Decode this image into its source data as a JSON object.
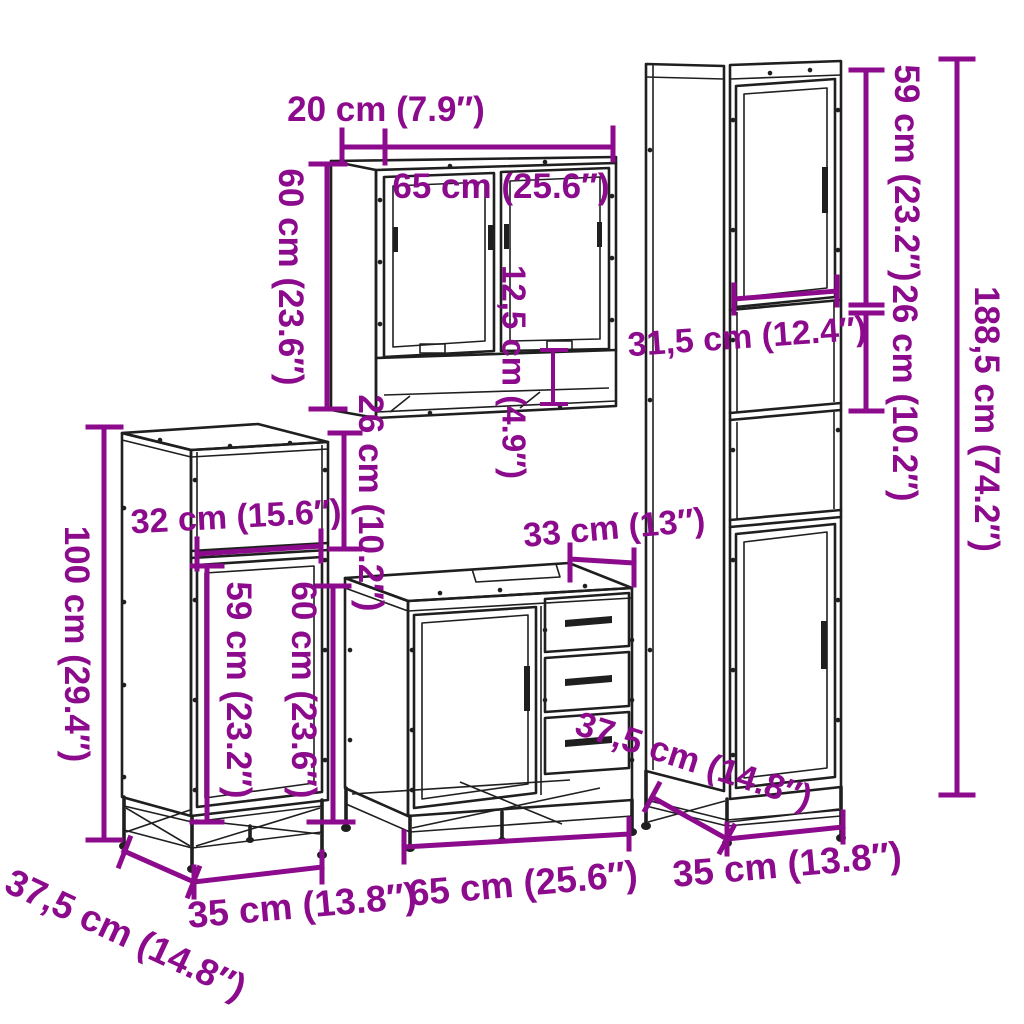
{
  "page": {
    "background": "#ffffff"
  },
  "colors": {
    "dimension_annotation": "#8c0a8c",
    "line_art": "#1f1f1f"
  },
  "diagram": {
    "title": "Bathroom furniture set dimension diagram",
    "pieces": {
      "mirror_cabinet": {
        "label": "wall mirror cabinet",
        "depth": "20 cm (7.9″)",
        "width": "65 cm (25.6″)",
        "height": "60 cm (23.6″)",
        "shelf_height": "12,5 cm (4.9″)",
        "wall_gap": "26 cm (10.2″)"
      },
      "tall_cabinet": {
        "label": "tall bathroom cabinet",
        "door_height": "59 cm (23.2″)",
        "shelf_height": "26 cm (10.2″)",
        "total_height": "188,5 cm (74.2″)",
        "inner_width": "31,5 cm (12.4″)",
        "width": "35 cm (13.8″)",
        "depth": "37,5 cm (14.8″)"
      },
      "side_cabinet": {
        "label": "low bathroom cabinet",
        "height": "100 cm (29.4″)",
        "inner_width": "32 cm (15.6″)",
        "door_height": "59 cm (23.2″)",
        "width": "35 cm (13.8″)",
        "depth": "37,5 cm (14.8″)"
      },
      "sink_cabinet": {
        "label": "bathroom sink cabinet",
        "height": "60 cm (23.6″)",
        "drawer_width": "33 cm (13″)",
        "width": "65 cm (25.6″)"
      }
    }
  }
}
